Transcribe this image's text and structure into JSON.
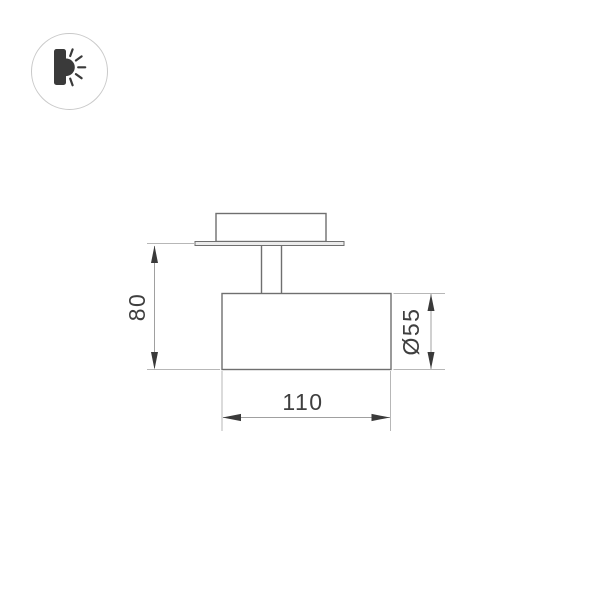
{
  "canvas": {
    "background": "#ffffff"
  },
  "badge": {
    "icon": "wall-light-icon",
    "circle_color": "#c9c9c9",
    "glyph_color": "#3a3a3a"
  },
  "drawing": {
    "kind": "technical-dimension-drawing",
    "subject": "surface-mounted spot light, side view",
    "colors": {
      "outline": "#6f6f6f",
      "plate_fill": "#ececec",
      "dimension_line": "#a0a0a0",
      "extension_line": "#b7b7b7",
      "arrow": "#3a3a3a",
      "text": "#3f3f3f"
    },
    "dimensions": {
      "height": {
        "label": "80",
        "orientation": "vertical",
        "side": "left"
      },
      "diameter": {
        "label": "Ø55",
        "orientation": "vertical",
        "side": "right"
      },
      "length": {
        "label": "110",
        "orientation": "horizontal",
        "side": "bottom"
      }
    }
  }
}
